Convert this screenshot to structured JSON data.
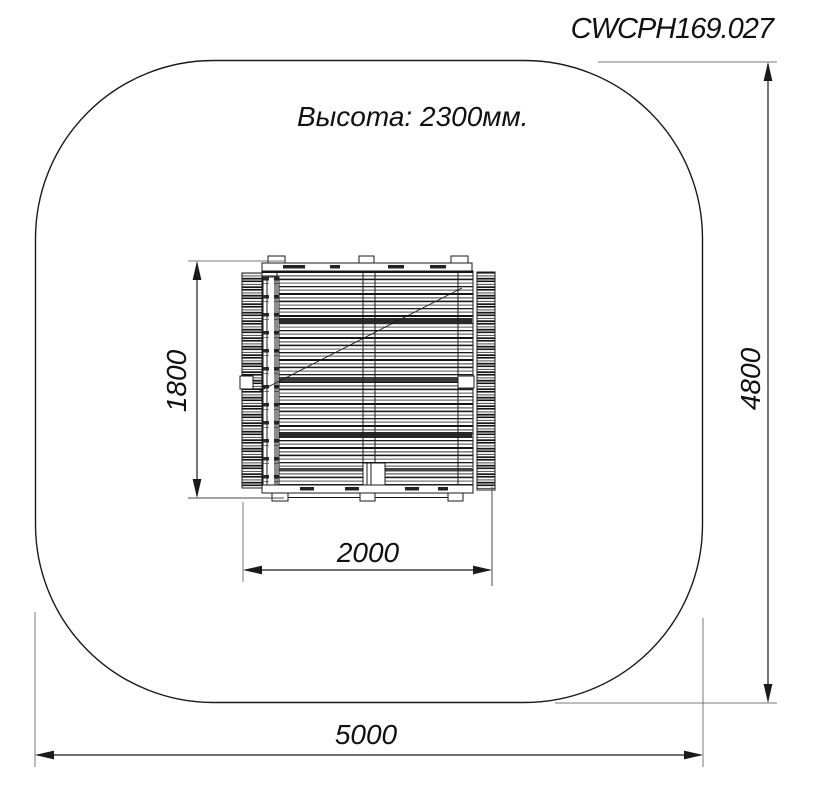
{
  "header": {
    "drawing_number": "CWCPH169.027"
  },
  "annotations": {
    "height_note": "Высота: 2300мм."
  },
  "dimensions": {
    "safety_zone_width_mm": "5000",
    "safety_zone_depth_mm": "4800",
    "equipment_width_mm": "2000",
    "equipment_depth_mm": "1800"
  },
  "colors": {
    "background": "#ffffff",
    "drawing_line": "#1a1a1a",
    "extension_line": "#787878",
    "text": "#111111"
  }
}
